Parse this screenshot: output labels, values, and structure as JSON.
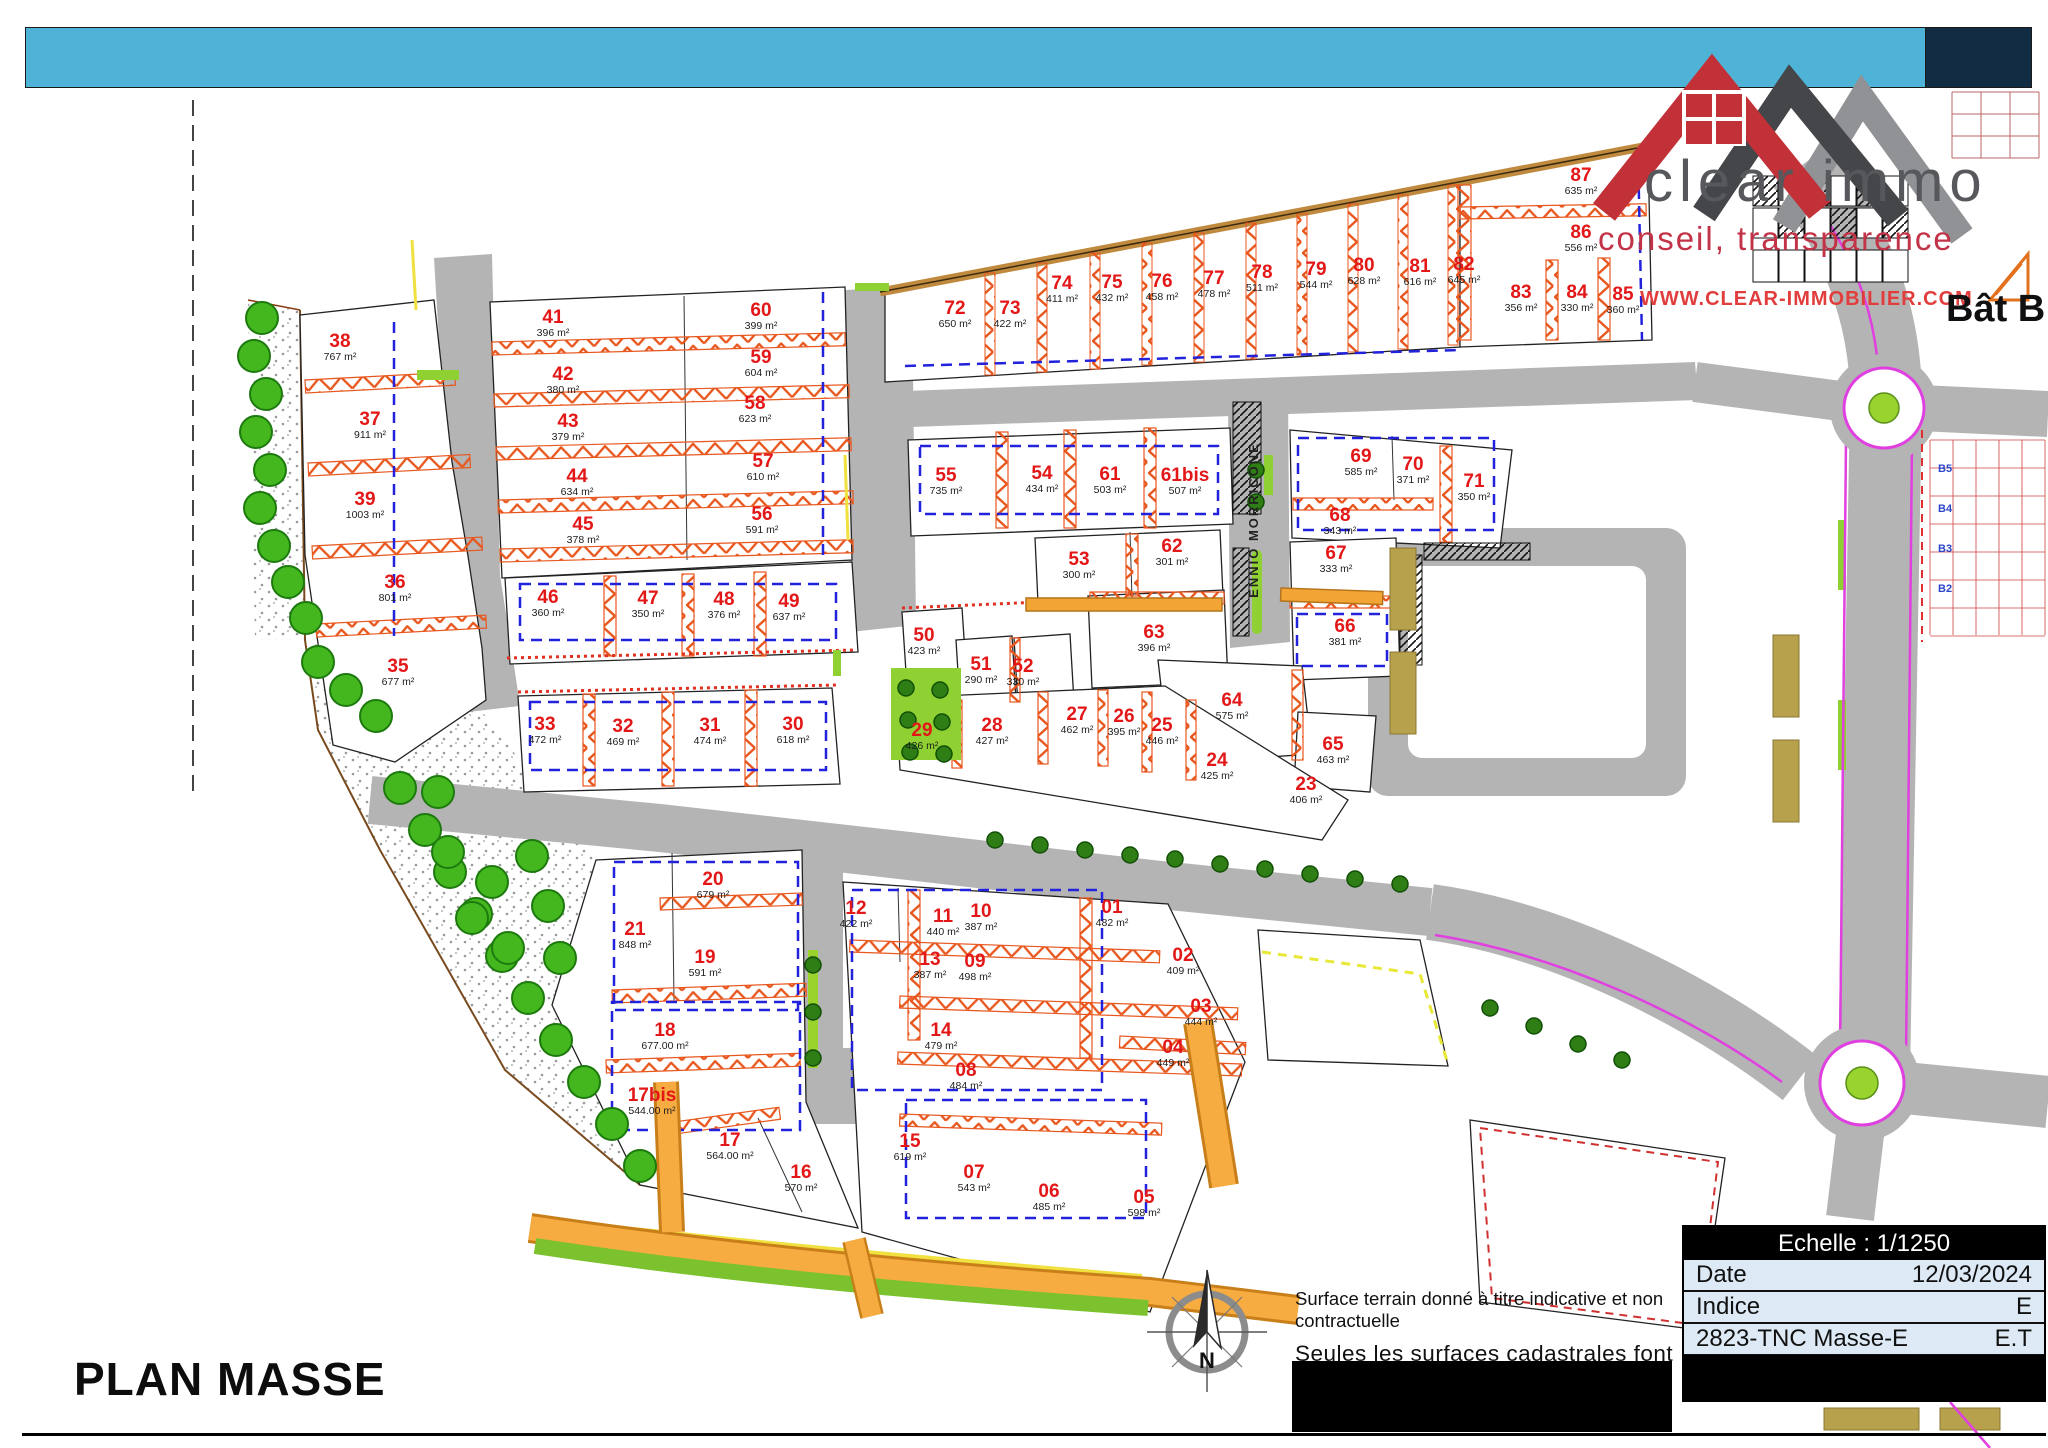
{
  "header": {
    "bar_color": "#4fb3d8",
    "navy_color": "#122c44"
  },
  "logo": {
    "name": "clear immo",
    "tagline": "conseil, transparence",
    "website": "WWW.CLEAR-IMMOBILIER.COM",
    "brand_red": "#c23038",
    "brand_gray": "#56585c"
  },
  "map": {
    "street_name": "ENNIO MORRICONE",
    "bat_b_label": "Bât B",
    "north_label": "N",
    "right_labels": [
      "B5",
      "B4",
      "B3",
      "B2"
    ],
    "lot_number_color": "#e31717",
    "hatch_color": "#e8571e",
    "road_color": "#b4b4b4"
  },
  "notes": {
    "line1": "Surface terrain donné à titre indicative et non contractuelle",
    "line2": "Seules les surfaces cadastrales font foi."
  },
  "title_block": {
    "scale_label": "Echelle : 1/1250",
    "rows": [
      {
        "label": "Date",
        "value": "12/03/2024"
      },
      {
        "label": "Indice",
        "value": "E"
      },
      {
        "label": "2823-TNC Masse-E",
        "value": "E.T"
      }
    ]
  },
  "footer": {
    "title": "PLAN MASSE"
  },
  "lots": [
    {
      "n": "38",
      "a": "767 m²",
      "x": 340,
      "y": 347
    },
    {
      "n": "37",
      "a": "911 m²",
      "x": 370,
      "y": 425
    },
    {
      "n": "39",
      "a": "1003 m²",
      "x": 365,
      "y": 505
    },
    {
      "n": "36",
      "a": "801 m²",
      "x": 395,
      "y": 588
    },
    {
      "n": "35",
      "a": "677 m²",
      "x": 398,
      "y": 672
    },
    {
      "n": "41",
      "a": "396 m²",
      "x": 553,
      "y": 323
    },
    {
      "n": "42",
      "a": "380 m²",
      "x": 563,
      "y": 380
    },
    {
      "n": "43",
      "a": "379 m²",
      "x": 568,
      "y": 427
    },
    {
      "n": "44",
      "a": "634 m²",
      "x": 577,
      "y": 482
    },
    {
      "n": "45",
      "a": "378 m²",
      "x": 583,
      "y": 530
    },
    {
      "n": "60",
      "a": "399 m²",
      "x": 761,
      "y": 316
    },
    {
      "n": "59",
      "a": "604 m²",
      "x": 761,
      "y": 363
    },
    {
      "n": "58",
      "a": "623 m²",
      "x": 755,
      "y": 409
    },
    {
      "n": "57",
      "a": "610 m²",
      "x": 763,
      "y": 467
    },
    {
      "n": "56",
      "a": "591 m²",
      "x": 762,
      "y": 520
    },
    {
      "n": "46",
      "a": "360 m²",
      "x": 548,
      "y": 603
    },
    {
      "n": "47",
      "a": "350 m²",
      "x": 648,
      "y": 604
    },
    {
      "n": "48",
      "a": "376 m²",
      "x": 724,
      "y": 605
    },
    {
      "n": "49",
      "a": "637 m²",
      "x": 789,
      "y": 607
    },
    {
      "n": "33",
      "a": "472 m²",
      "x": 545,
      "y": 730
    },
    {
      "n": "32",
      "a": "469 m²",
      "x": 623,
      "y": 732
    },
    {
      "n": "31",
      "a": "474 m²",
      "x": 710,
      "y": 731
    },
    {
      "n": "30",
      "a": "618 m²",
      "x": 793,
      "y": 730
    },
    {
      "n": "72",
      "a": "650 m²",
      "x": 955,
      "y": 314
    },
    {
      "n": "73",
      "a": "422 m²",
      "x": 1010,
      "y": 314
    },
    {
      "n": "74",
      "a": "411 m²",
      "x": 1062,
      "y": 289
    },
    {
      "n": "75",
      "a": "432 m²",
      "x": 1112,
      "y": 288
    },
    {
      "n": "76",
      "a": "458 m²",
      "x": 1162,
      "y": 287
    },
    {
      "n": "77",
      "a": "478 m²",
      "x": 1214,
      "y": 284
    },
    {
      "n": "78",
      "a": "511 m²",
      "x": 1262,
      "y": 278
    },
    {
      "n": "79",
      "a": "544 m²",
      "x": 1316,
      "y": 275
    },
    {
      "n": "80",
      "a": "628 m²",
      "x": 1364,
      "y": 271
    },
    {
      "n": "81",
      "a": "616 m²",
      "x": 1420,
      "y": 272
    },
    {
      "n": "82",
      "a": "645 m²",
      "x": 1464,
      "y": 270
    },
    {
      "n": "83",
      "a": "356 m²",
      "x": 1521,
      "y": 298
    },
    {
      "n": "84",
      "a": "330 m²",
      "x": 1577,
      "y": 298
    },
    {
      "n": "85",
      "a": "360 m²",
      "x": 1623,
      "y": 300
    },
    {
      "n": "86",
      "a": "556 m²",
      "x": 1581,
      "y": 238
    },
    {
      "n": "87",
      "a": "635 m²",
      "x": 1581,
      "y": 181
    },
    {
      "n": "55",
      "a": "735 m²",
      "x": 946,
      "y": 481
    },
    {
      "n": "54",
      "a": "434 m²",
      "x": 1042,
      "y": 479
    },
    {
      "n": "61",
      "a": "503 m²",
      "x": 1110,
      "y": 480
    },
    {
      "n": "61bis",
      "a": "507 m²",
      "x": 1185,
      "y": 481
    },
    {
      "n": "69",
      "a": "585 m²",
      "x": 1361,
      "y": 462
    },
    {
      "n": "70",
      "a": "371 m²",
      "x": 1413,
      "y": 470
    },
    {
      "n": "71",
      "a": "350 m²",
      "x": 1474,
      "y": 487
    },
    {
      "n": "68",
      "a": "343 m²",
      "x": 1340,
      "y": 521
    },
    {
      "n": "53",
      "a": "300 m²",
      "x": 1079,
      "y": 565
    },
    {
      "n": "62",
      "a": "301 m²",
      "x": 1172,
      "y": 552
    },
    {
      "n": "67",
      "a": "333 m²",
      "x": 1336,
      "y": 559
    },
    {
      "n": "66",
      "a": "381 m²",
      "x": 1345,
      "y": 632
    },
    {
      "n": "63",
      "a": "396 m²",
      "x": 1154,
      "y": 638
    },
    {
      "n": "64",
      "a": "575 m²",
      "x": 1232,
      "y": 706
    },
    {
      "n": "65",
      "a": "463 m²",
      "x": 1333,
      "y": 750
    },
    {
      "n": "50",
      "a": "423 m²",
      "x": 924,
      "y": 641
    },
    {
      "n": "51",
      "a": "290 m²",
      "x": 981,
      "y": 670
    },
    {
      "n": "52",
      "a": "330 m²",
      "x": 1023,
      "y": 672
    },
    {
      "n": "29",
      "a": "426 m²",
      "x": 922,
      "y": 736
    },
    {
      "n": "28",
      "a": "427 m²",
      "x": 992,
      "y": 731
    },
    {
      "n": "27",
      "a": "462 m²",
      "x": 1077,
      "y": 720
    },
    {
      "n": "26",
      "a": "395 m²",
      "x": 1124,
      "y": 722
    },
    {
      "n": "25",
      "a": "446 m²",
      "x": 1162,
      "y": 731
    },
    {
      "n": "24",
      "a": "425 m²",
      "x": 1217,
      "y": 766
    },
    {
      "n": "23",
      "a": "406 m²",
      "x": 1306,
      "y": 790
    },
    {
      "n": "20",
      "a": "679 m²",
      "x": 713,
      "y": 885
    },
    {
      "n": "21",
      "a": "848 m²",
      "x": 635,
      "y": 935
    },
    {
      "n": "19",
      "a": "591 m²",
      "x": 705,
      "y": 963
    },
    {
      "n": "18",
      "a": "677.00 m²",
      "x": 665,
      "y": 1036
    },
    {
      "n": "17bis",
      "a": "544.00 m²",
      "x": 652,
      "y": 1101
    },
    {
      "n": "17",
      "a": "564.00 m²",
      "x": 730,
      "y": 1146
    },
    {
      "n": "16",
      "a": "570 m²",
      "x": 801,
      "y": 1178
    },
    {
      "n": "15",
      "a": "619 m²",
      "x": 910,
      "y": 1147
    },
    {
      "n": "12",
      "a": "422 m²",
      "x": 856,
      "y": 914
    },
    {
      "n": "11",
      "a": "440 m²",
      "x": 943,
      "y": 922
    },
    {
      "n": "10",
      "a": "387 m²",
      "x": 981,
      "y": 917
    },
    {
      "n": "13",
      "a": "387 m²",
      "x": 930,
      "y": 965
    },
    {
      "n": "09",
      "a": "498 m²",
      "x": 975,
      "y": 967
    },
    {
      "n": "14",
      "a": "479 m²",
      "x": 941,
      "y": 1036
    },
    {
      "n": "08",
      "a": "484 m²",
      "x": 966,
      "y": 1076
    },
    {
      "n": "07",
      "a": "543 m²",
      "x": 974,
      "y": 1178
    },
    {
      "n": "06",
      "a": "485 m²",
      "x": 1049,
      "y": 1197
    },
    {
      "n": "05",
      "a": "598 m²",
      "x": 1144,
      "y": 1203
    },
    {
      "n": "04",
      "a": "449 m²",
      "x": 1173,
      "y": 1053
    },
    {
      "n": "03",
      "a": "444 m²",
      "x": 1201,
      "y": 1012
    },
    {
      "n": "02",
      "a": "409 m²",
      "x": 1183,
      "y": 961
    },
    {
      "n": "01",
      "a": "482 m²",
      "x": 1112,
      "y": 913
    }
  ]
}
